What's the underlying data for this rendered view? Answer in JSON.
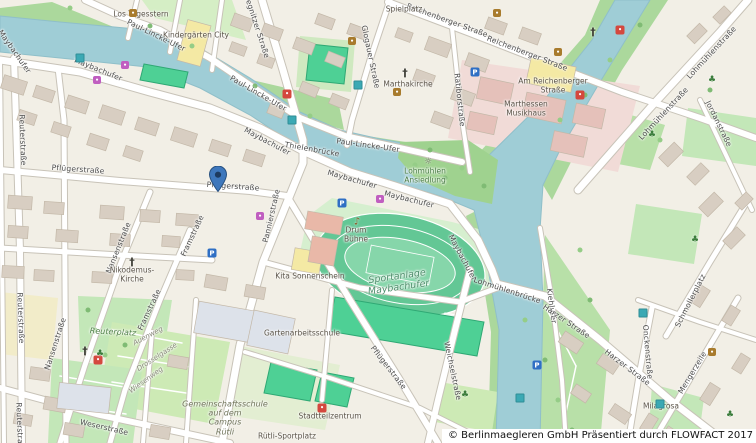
{
  "map": {
    "attribution": "© Berlinmaegleren GmbH Präsentiert durch FLOWFACT 2017",
    "colors": {
      "land": "#f2efe6",
      "water": "#9fcdd6",
      "bank_green": "#abd89c",
      "park": "#c3e7b8",
      "pitch": "#4ed095",
      "track": "#63c795",
      "building": "#d8cec2",
      "hospital_area": "#f1dbd7",
      "school_yellow": "#f4e9a4",
      "road": "#ffffff",
      "marker_blue": "#3e77bc"
    },
    "marker": {
      "x": 218,
      "y": 192
    },
    "street_labels": [
      {
        "text": "Maybachufer",
        "x": 14,
        "y": 52,
        "rot": 55
      },
      {
        "text": "Maybachufer",
        "x": 98,
        "y": 70,
        "rot": 22
      },
      {
        "text": "Maybachufer",
        "x": 267,
        "y": 142,
        "rot": 28
      },
      {
        "text": "Maybachufer",
        "x": 352,
        "y": 180,
        "rot": 16
      },
      {
        "text": "Maybachufer",
        "x": 409,
        "y": 200,
        "rot": 14
      },
      {
        "text": "Maybachufer",
        "x": 462,
        "y": 258,
        "rot": 62
      },
      {
        "text": "Paul-Lincke-Ufer",
        "x": 156,
        "y": 36,
        "rot": 26
      },
      {
        "text": "Paul-Lincke-Ufer",
        "x": 258,
        "y": 94,
        "rot": 30
      },
      {
        "text": "Paul-Lincke-Ufer",
        "x": 368,
        "y": 146,
        "rot": 8
      },
      {
        "text": "Pflügerstraße",
        "x": 78,
        "y": 170,
        "rot": 4
      },
      {
        "text": "Pflügerstraße",
        "x": 233,
        "y": 187,
        "rot": 4
      },
      {
        "text": "Pflügerstraße",
        "x": 388,
        "y": 368,
        "rot": 52
      },
      {
        "text": "Pannierstraße",
        "x": 272,
        "y": 216,
        "rot": -77
      },
      {
        "text": "Nansenstraße",
        "x": 119,
        "y": 248,
        "rot": -68
      },
      {
        "text": "Nansenstraße",
        "x": 56,
        "y": 344,
        "rot": -72
      },
      {
        "text": "Framstraße",
        "x": 193,
        "y": 236,
        "rot": -65
      },
      {
        "text": "Framstraße",
        "x": 150,
        "y": 310,
        "rot": -65
      },
      {
        "text": "Reuterstraße",
        "x": 22,
        "y": 140,
        "rot": 88
      },
      {
        "text": "Reuterstraße",
        "x": 20,
        "y": 318,
        "rot": 88
      },
      {
        "text": "Reuterstraße",
        "x": 19,
        "y": 428,
        "rot": 88
      },
      {
        "text": "Weserstraße",
        "x": 104,
        "y": 428,
        "rot": 13
      },
      {
        "text": "Glogauer Straße",
        "x": 370,
        "y": 57,
        "rot": 78
      },
      {
        "text": "Liegnitzer Straße",
        "x": 256,
        "y": 26,
        "rot": 72
      },
      {
        "text": "Ratiborstraße",
        "x": 459,
        "y": 100,
        "rot": 84
      },
      {
        "text": "Reichenberger Straße",
        "x": 447,
        "y": 21,
        "rot": 20
      },
      {
        "text": "Reichenberger Straße",
        "x": 527,
        "y": 54,
        "rot": 21
      },
      {
        "text": "Lohmühlenstraße",
        "x": 712,
        "y": 53,
        "rot": -47
      },
      {
        "text": "Lohmühlenstraße",
        "x": 664,
        "y": 114,
        "rot": -47
      },
      {
        "text": "Jordanstraße",
        "x": 718,
        "y": 124,
        "rot": 64
      },
      {
        "text": "Kiehlufer",
        "x": 551,
        "y": 306,
        "rot": 82
      },
      {
        "text": "Harzer Straße",
        "x": 566,
        "y": 322,
        "rot": 34
      },
      {
        "text": "Harzer Straße",
        "x": 627,
        "y": 368,
        "rot": 37
      },
      {
        "text": "Onckenstraße",
        "x": 647,
        "y": 352,
        "rot": 85
      },
      {
        "text": "Mengerzeile",
        "x": 693,
        "y": 373,
        "rot": -59
      },
      {
        "text": "Schmollerplatz",
        "x": 691,
        "y": 301,
        "rot": -63
      },
      {
        "text": "Weichselstraße",
        "x": 452,
        "y": 371,
        "rot": 78
      },
      {
        "text": "Thielenbrücke",
        "x": 312,
        "y": 150,
        "rot": 10
      },
      {
        "text": "Lohmühlenbrücke",
        "x": 507,
        "y": 291,
        "rot": 18
      }
    ],
    "place_labels": [
      {
        "text": "Sportanlage\nMaybachufer",
        "x": 398,
        "y": 283,
        "rot": -8,
        "kind": "sport"
      },
      {
        "text": "Reuterplatz",
        "x": 113,
        "y": 332,
        "rot": 3,
        "kind": "park"
      },
      {
        "text": "Gemeinschaftsschule\nauf dem\nCampus\nRütli",
        "x": 225,
        "y": 418,
        "rot": 0,
        "kind": "campus"
      },
      {
        "text": "Lohmühlen\nAnsiedlung",
        "x": 425,
        "y": 176,
        "rot": 0,
        "kind": "green-poi"
      },
      {
        "text": "Marthakirche",
        "x": 408,
        "y": 85,
        "rot": 0,
        "kind": "poi"
      },
      {
        "text": "Marthessen\nMusikhaus",
        "x": 526,
        "y": 109,
        "rot": 0,
        "kind": "poi"
      },
      {
        "text": "Am Reichenberger\nStraße",
        "x": 553,
        "y": 86,
        "rot": 0,
        "kind": "poi"
      },
      {
        "text": "Nikodemus-\nKirche",
        "x": 132,
        "y": 275,
        "rot": 0,
        "kind": "poi"
      },
      {
        "text": "Kita Sonnenschein",
        "x": 310,
        "y": 277,
        "rot": 0,
        "kind": "poi"
      },
      {
        "text": "Kindergärten City",
        "x": 196,
        "y": 36,
        "rot": 0,
        "kind": "poi"
      },
      {
        "text": "Gartenarbeitsschule",
        "x": 302,
        "y": 334,
        "rot": 0,
        "kind": "poi"
      },
      {
        "text": "Rütli-Sportplatz",
        "x": 287,
        "y": 437,
        "rot": 0,
        "kind": "poi"
      },
      {
        "text": "Stadtteilzentrum",
        "x": 330,
        "y": 417,
        "rot": 0,
        "kind": "poi"
      },
      {
        "text": "Drum\nBühne",
        "x": 356,
        "y": 235,
        "rot": 0,
        "kind": "poi"
      },
      {
        "text": "Los Tagesstern",
        "x": 141,
        "y": 15,
        "rot": 0,
        "kind": "poi"
      },
      {
        "text": "Milagrosa",
        "x": 661,
        "y": 407,
        "rot": 0,
        "kind": "poi"
      },
      {
        "text": "Spielplatz",
        "x": 404,
        "y": 10,
        "rot": 0,
        "kind": "poi"
      },
      {
        "text": "Auenweg",
        "x": 148,
        "y": 336,
        "rot": -28,
        "kind": "path"
      },
      {
        "text": "Drosselgasse",
        "x": 157,
        "y": 357,
        "rot": -33,
        "kind": "path"
      },
      {
        "text": "Wiesenweg",
        "x": 146,
        "y": 380,
        "rot": -36,
        "kind": "path"
      }
    ],
    "icons": [
      {
        "kind": "parking",
        "x": 342,
        "y": 203
      },
      {
        "kind": "parking",
        "x": 475,
        "y": 72
      },
      {
        "kind": "parking",
        "x": 212,
        "y": 253
      },
      {
        "kind": "parking",
        "x": 537,
        "y": 365
      },
      {
        "kind": "transit",
        "x": 80,
        "y": 58
      },
      {
        "kind": "transit",
        "x": 358,
        "y": 85
      },
      {
        "kind": "transit",
        "x": 292,
        "y": 120
      },
      {
        "kind": "transit",
        "x": 520,
        "y": 398
      },
      {
        "kind": "transit",
        "x": 660,
        "y": 404
      },
      {
        "kind": "transit",
        "x": 643,
        "y": 313
      },
      {
        "kind": "church",
        "x": 405,
        "y": 73
      },
      {
        "kind": "church",
        "x": 132,
        "y": 262
      },
      {
        "kind": "church",
        "x": 85,
        "y": 351
      },
      {
        "kind": "church",
        "x": 593,
        "y": 32
      },
      {
        "kind": "poi-red",
        "x": 287,
        "y": 94
      },
      {
        "kind": "poi-red",
        "x": 620,
        "y": 30
      },
      {
        "kind": "poi-red",
        "x": 322,
        "y": 408
      },
      {
        "kind": "poi-red",
        "x": 98,
        "y": 360
      },
      {
        "kind": "poi-red",
        "x": 580,
        "y": 95
      },
      {
        "kind": "poi-magenta",
        "x": 125,
        "y": 65
      },
      {
        "kind": "poi-magenta",
        "x": 97,
        "y": 80
      },
      {
        "kind": "poi-magenta",
        "x": 260,
        "y": 216
      },
      {
        "kind": "poi-magenta",
        "x": 380,
        "y": 199
      },
      {
        "kind": "poi-brown",
        "x": 133,
        "y": 13
      },
      {
        "kind": "poi-brown",
        "x": 352,
        "y": 41
      },
      {
        "kind": "poi-brown",
        "x": 397,
        "y": 92
      },
      {
        "kind": "poi-brown",
        "x": 712,
        "y": 352
      },
      {
        "kind": "poi-brown",
        "x": 497,
        "y": 13
      },
      {
        "kind": "poi-brown",
        "x": 558,
        "y": 52
      },
      {
        "kind": "music",
        "x": 357,
        "y": 222
      },
      {
        "kind": "playground",
        "x": 100,
        "y": 354
      },
      {
        "kind": "playground",
        "x": 652,
        "y": 135
      },
      {
        "kind": "playground",
        "x": 712,
        "y": 80
      },
      {
        "kind": "playground",
        "x": 730,
        "y": 415
      },
      {
        "kind": "playground",
        "x": 465,
        "y": 395
      },
      {
        "kind": "playground",
        "x": 695,
        "y": 240
      },
      {
        "kind": "viewpoint",
        "x": 428,
        "y": 162
      }
    ]
  }
}
